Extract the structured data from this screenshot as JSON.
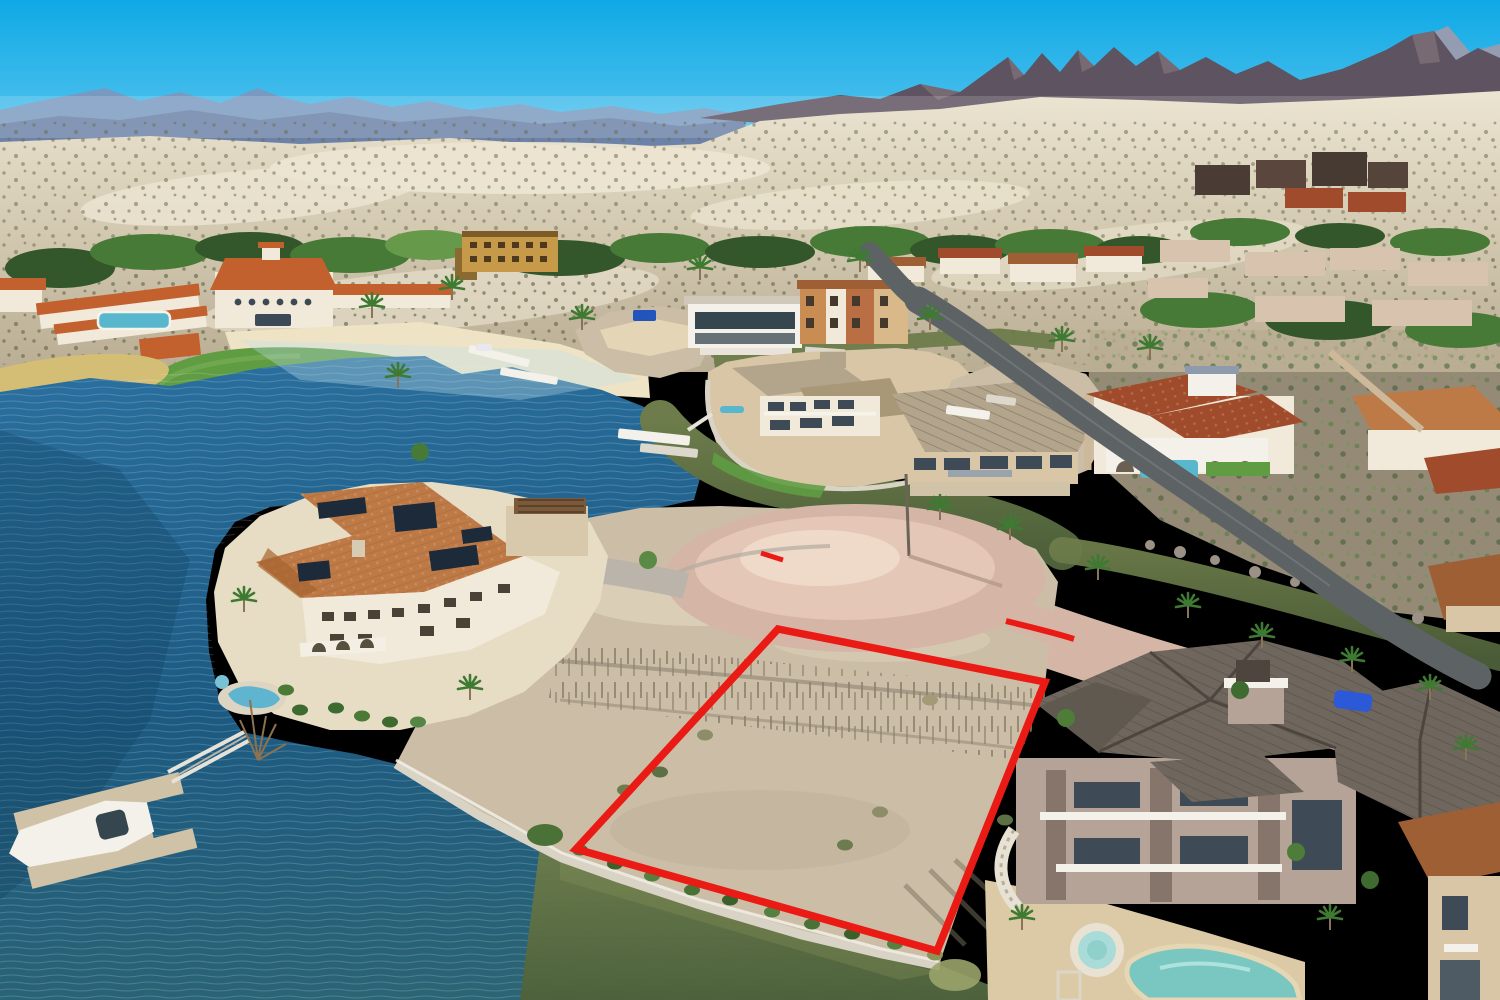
{
  "meta": {
    "kind": "aerial-drone-photograph",
    "subject": "Lakefront desert luxury community with a vacant waterfront lot outlined in red (real-estate listing photo)",
    "width_px": 1500,
    "height_px": 1000,
    "visible_text": "none"
  },
  "scene": {
    "sky": "clear cyan desert sky",
    "background": "hazy blue mountain ranges left, jagged dark purple peaks right, pale scrub-speckled bajada slope",
    "midground": "Mediterranean resort clubhouse with orange tile roofs, beach, lawn, palm trees, stucco homes with tile roofs, winding asphalt road",
    "water": "deep blue lake at left turning olive-green in the shoreline canal at bottom",
    "foreground": "terracotta-roof mansion with solar panels and kidney pool, U-shaped boat dock with white boat, paver cul-de-sac, vacant dirt bluff lot outlined in red, large two-story home with dark shingle roofs, lagoon pool and round spa"
  },
  "red_lot": {
    "label": "property-boundary-outline",
    "points": "778,629 1045,682 937,951 576,849",
    "stroke_width": 7.5,
    "curb_left": "M761,553 L783,560",
    "curb_right": "M1006,621 C1030,627 1052,632 1074,639"
  },
  "elements": [
    {
      "name": "sky"
    },
    {
      "name": "mountains-far-left"
    },
    {
      "name": "mountains-right-jagged"
    },
    {
      "name": "desert-bajada"
    },
    {
      "name": "resort-clubhouse"
    },
    {
      "name": "resort-casitas"
    },
    {
      "name": "resort-pool"
    },
    {
      "name": "beach-sand"
    },
    {
      "name": "lawn"
    },
    {
      "name": "reed-bed"
    },
    {
      "name": "lake"
    },
    {
      "name": "canal-north"
    },
    {
      "name": "canal-bottom"
    },
    {
      "name": "sand-stockpile"
    },
    {
      "name": "modern-glass-house"
    },
    {
      "name": "townhouse-row"
    },
    {
      "name": "peninsula-house"
    },
    {
      "name": "tan-roof-house"
    },
    {
      "name": "spanish-villa"
    },
    {
      "name": "orange-lodge-building"
    },
    {
      "name": "hillside-homes"
    },
    {
      "name": "asphalt-road"
    },
    {
      "name": "paver-road"
    },
    {
      "name": "cul-de-sac"
    },
    {
      "name": "mansion-terracotta-roof"
    },
    {
      "name": "solar-panels"
    },
    {
      "name": "kidney-pool"
    },
    {
      "name": "boat-dock"
    },
    {
      "name": "white-boat"
    },
    {
      "name": "gangway"
    },
    {
      "name": "vacant-lot-dirt-bluff"
    },
    {
      "name": "red-boundary-overlay"
    },
    {
      "name": "big-house-dark-roof"
    },
    {
      "name": "lagoon-pool"
    },
    {
      "name": "round-spa"
    },
    {
      "name": "blue-car"
    },
    {
      "name": "palm-trees"
    },
    {
      "name": "seawall"
    }
  ],
  "colors": {
    "sky-top": "#0fa9e6",
    "sky-mid": "#63c9ef",
    "sky-horizon": "#c6ecf8",
    "mtn-far": "#a09aab",
    "mtn-left": "#8494b8",
    "mtn-left-dark": "#67799f",
    "mtn-right": "#5e5360",
    "mtn-right-light": "#7e7078",
    "desert-light": "#ece5d2",
    "desert": "#d3c9b1",
    "desert-dark": "#b9ad93",
    "scrub": "#6e6f51",
    "tree-dark": "#33572b",
    "tree": "#477a36",
    "tree-light": "#669a4a",
    "palm": "#3f7a33",
    "trunk": "#8a7456",
    "lawn": "#5f9c42",
    "sand": "#efe3c6",
    "reeds": "#d4bd74",
    "lake-deep": "#1c5a82",
    "lake": "#2a6f9e",
    "lake-teal": "#2b6475",
    "canal": "#6d7c4a",
    "canal-dark": "#4e613a",
    "seawall": "#d9d3c6",
    "dock": "#cfc2a6",
    "white": "#f4f1ea",
    "roof-orange": "#c2602e",
    "roof-terra": "#bd7a47",
    "roof-terra-dark": "#9e5f35",
    "roof-red": "#a04b2c",
    "roof-pink": "#d8c3af",
    "roof-tan": "#b3a48c",
    "roof-dark": "#6f675d",
    "roof-dark-line": "#544e47",
    "wall-cream": "#f1e9d9",
    "wall-tan": "#d9c6a7",
    "wall-mustard": "#c79a4a",
    "wall-mauve": "#b4a396",
    "stone": "#86756a",
    "glass": "#36464f",
    "pool": "#58b7cc",
    "pool-lagoon": "#7ac6c0",
    "paver": "#d5b6a6",
    "paver-light": "#e4c7b6",
    "asphalt": "#5d6365",
    "drive": "#bbb4aa",
    "dirt": "#cbbda6",
    "dirt-dark": "#8a7f6d",
    "red": "#ea1b14",
    "car-blue": "#2b59d8",
    "boat-red": "#c03a2e"
  }
}
